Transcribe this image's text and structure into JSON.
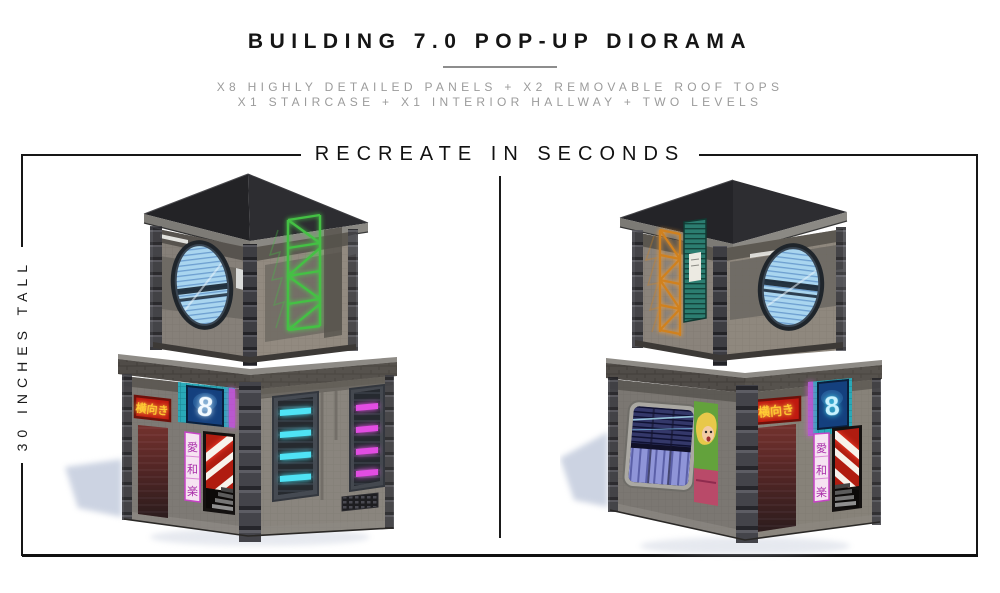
{
  "header": {
    "title": "BUILDING 7.0 POP-UP DIORAMA",
    "subtitle_line1": "X8 HIGHLY DETAILED PANELS + X2 REMOVABLE ROOF TOPS",
    "subtitle_line2": "X1 STAIRCASE + X1 INTERIOR HALLWAY + TWO LEVELS"
  },
  "measure_frame": {
    "banner_label": "RECREATE IN SECONDS",
    "height_label": "30 INCHES TALL"
  },
  "diorama": {
    "number_sign": "8",
    "red_sign_text": "横向き",
    "vertical_sign_chars": [
      "愛",
      "和",
      "楽"
    ],
    "colors": {
      "neon_green": "#44c144",
      "neon_orange": "#d0811e",
      "neon_cyan": "#4fe3f5",
      "neon_magenta": "#e24de2",
      "red_sign_bg": "#c01910",
      "sign_text_yellow": "#ffcc33",
      "number_sign_bg": "#14407e",
      "teal_tiles": "#2aa9b8",
      "porthole_rim": "#1f252b",
      "shadow_blue": "#b7c1d6"
    }
  }
}
